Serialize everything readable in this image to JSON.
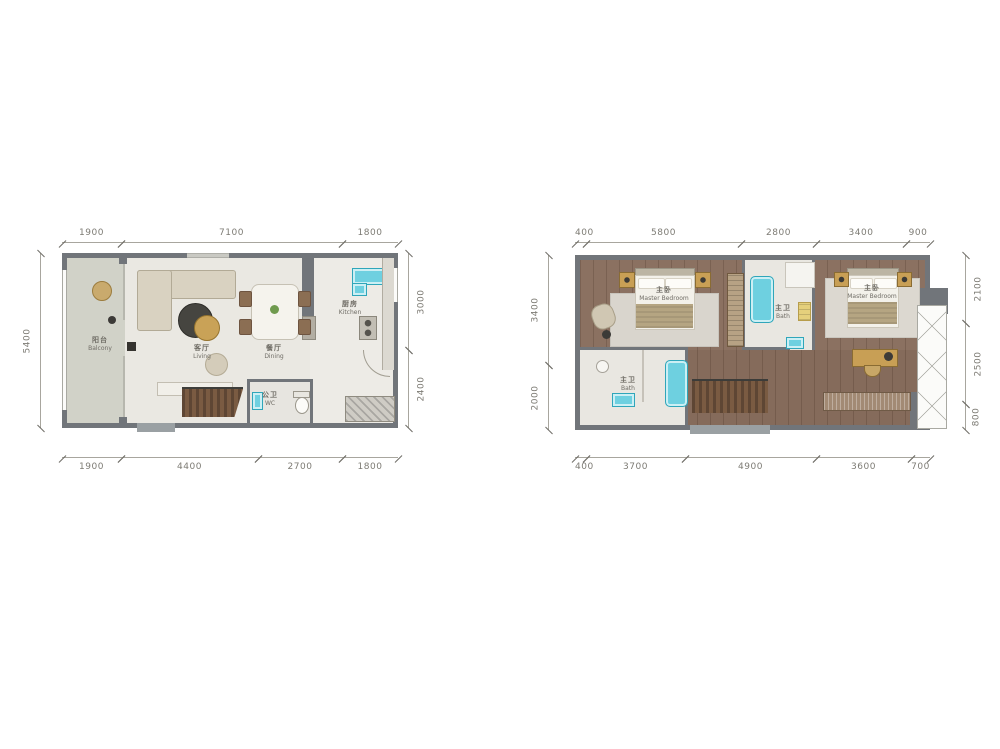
{
  "page": {
    "background": "#ffffff"
  },
  "colors": {
    "wall": "#71757a",
    "marble_floor": "#eae8e2",
    "balcony_floor": "#d1d2c8",
    "wood_floor": "#8b7161",
    "stair_wood": "#6b4f3d",
    "fixture_cyan": "#6ed0e0",
    "gold_furniture": "#c89f55",
    "dim_text": "#7d7b74"
  },
  "plan_left": {
    "dims_top": [
      "1900",
      "7100",
      "1800"
    ],
    "dims_bottom": [
      "1900",
      "4400",
      "2700",
      "1800"
    ],
    "dims_left": [
      "5400"
    ],
    "dims_right": [
      "3000",
      "2400"
    ],
    "rooms": {
      "balcony": {
        "zh": "阳台",
        "en": "Balcony"
      },
      "living": {
        "zh": "客厅",
        "en": "Living"
      },
      "dining": {
        "zh": "餐厅",
        "en": "Dining"
      },
      "kitchen": {
        "zh": "厨房",
        "en": "Kitchen"
      },
      "wc": {
        "zh": "公卫",
        "en": "WC"
      }
    }
  },
  "plan_right": {
    "dims_top": [
      "400",
      "5800",
      "2800",
      "3400",
      "900"
    ],
    "dims_bottom": [
      "400",
      "3700",
      "4900",
      "3600",
      "700"
    ],
    "dims_left": [
      "3400",
      "2000"
    ],
    "dims_right": [
      "2100",
      "2500",
      "800"
    ],
    "rooms": {
      "master_bedroom_1": {
        "zh": "主卧",
        "en": "Master Bedroom"
      },
      "bath_1": {
        "zh": "主卫",
        "en": "Bath"
      },
      "bath_2": {
        "zh": "主卫",
        "en": "Bath"
      },
      "master_bedroom_2": {
        "zh": "主卧",
        "en": "Master Bedroom"
      }
    }
  }
}
